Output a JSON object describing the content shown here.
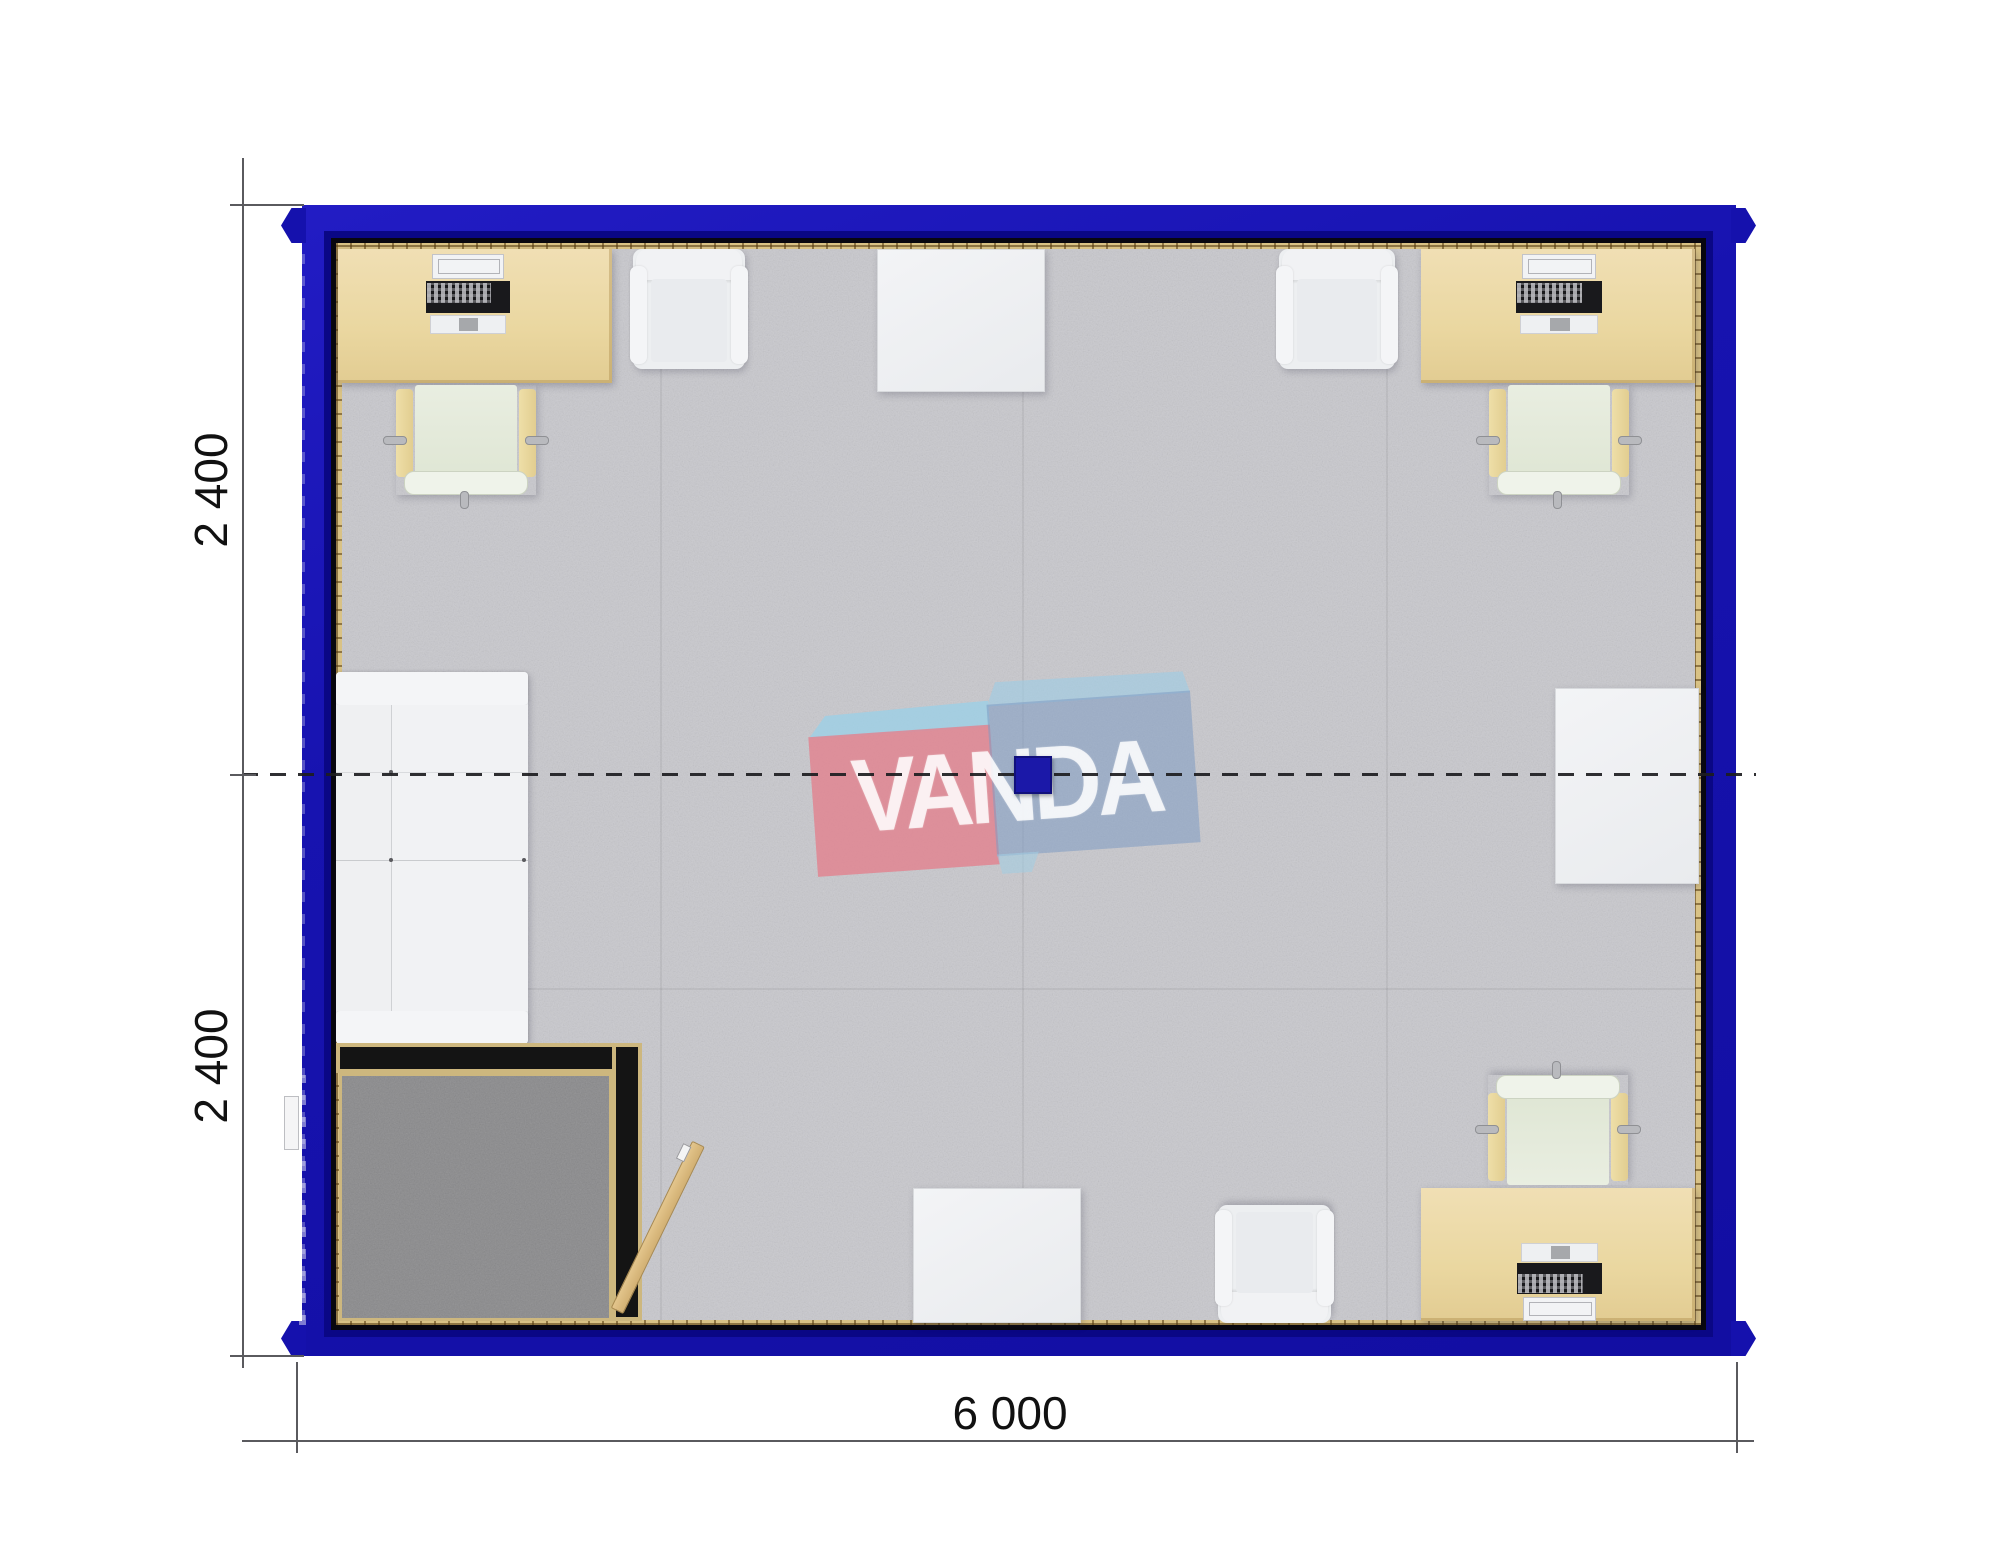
{
  "page": {
    "description": "Top-down rendered floor plan of a 6.0 x 4.8 m modular office container made of two 2.4 m modules",
    "background": "#ffffff"
  },
  "dimensions": {
    "bottom": {
      "label": "6 000"
    },
    "left_top": {
      "label": "2 400"
    },
    "left_bottom": {
      "label": "2 400"
    }
  },
  "watermark": {
    "text": "VANDA",
    "pink_box_color": "#e2828f",
    "blue_box_color": "#7d9bc3",
    "flap_color": "#a0cde4"
  },
  "palette": {
    "wall_blue": "#1713b0",
    "wall_blue_dark": "#0a0785",
    "wall_liner_black": "#08070f",
    "trim_tan": "#d9c285",
    "carpet_gray": "#c8c8cd",
    "vestibule_carpet": "#8d8d8f",
    "desk_beige": "#ead7a0",
    "furniture_white": "#eef0f2",
    "chair_seat_green": "#e5ebdc",
    "door_tan": "#d9ba80",
    "center_square_blue": "#1b18a8",
    "dimension_text": "#111111"
  },
  "furniture_inventory": [
    {
      "name": "desk-with-laptop",
      "count": 3
    },
    {
      "name": "office-chair",
      "count": 3
    },
    {
      "name": "armchair",
      "count": 3
    },
    {
      "name": "white-side-table",
      "count": 3
    },
    {
      "name": "sofa",
      "count": 1
    },
    {
      "name": "entry-vestibule-with-open-door",
      "count": 1
    }
  ]
}
